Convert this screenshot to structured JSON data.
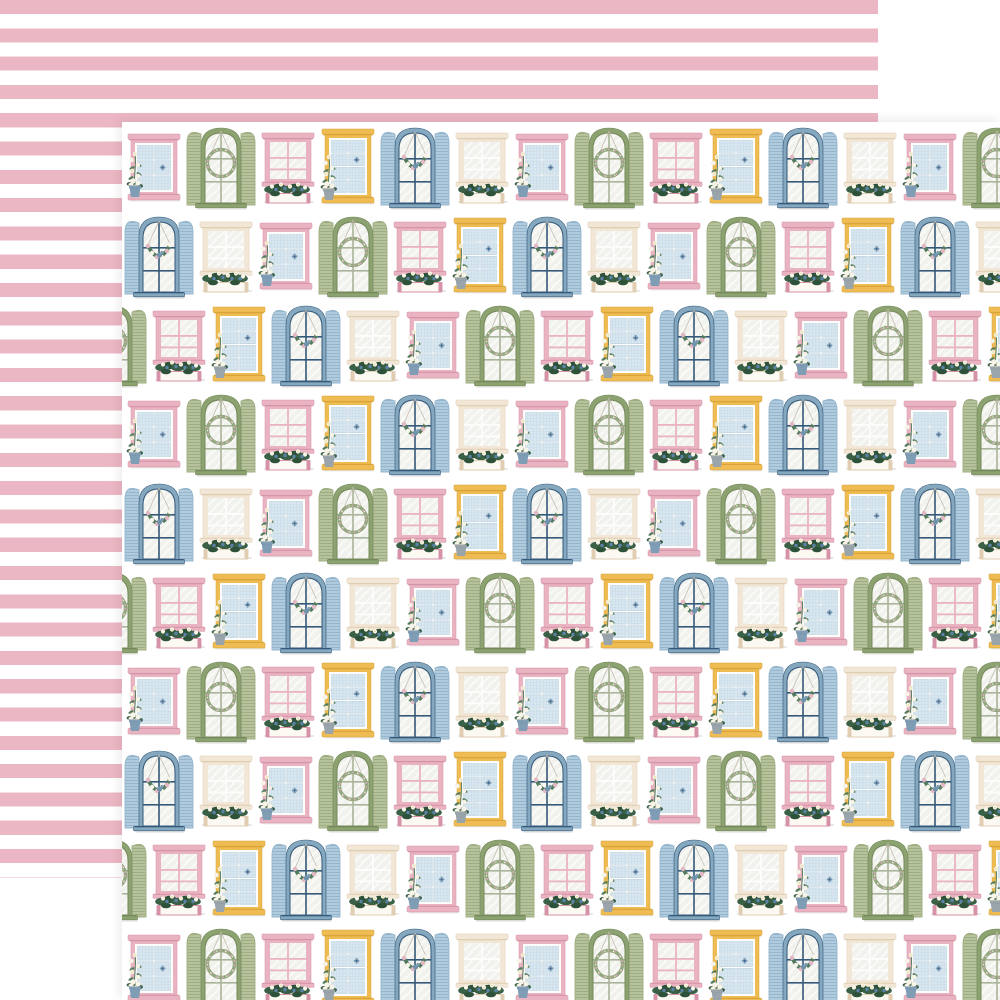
{
  "product": {
    "description": "Double-sided patterned scrapbook paper, front side with pastel cottage windows, reverse side with pink stripes",
    "front_motif": "cottage-windows-pattern",
    "back_motif": "pink-white-stripes"
  },
  "canvas": {
    "width": 1000,
    "height": 1000,
    "background": "#ffffff"
  },
  "back_sheet": {
    "x": 0,
    "y": 0,
    "size": 878,
    "stripe_color": "#ecb7c4",
    "gap_color": "#ffffff",
    "stripe_height": 14.15
  },
  "front_sheet": {
    "x": 122,
    "y": 122,
    "size": 878,
    "background": "#ffffff"
  },
  "palette": {
    "pane": "#d8e7f0",
    "pane_line": "#c6dae6",
    "pane_stroke": "#abc6d8",
    "glass": "#f1f2ee",
    "glass_streak": "#fbfbf8",
    "sash_white": "#fefdfb",
    "pink_frame": "#e9b3c1",
    "pink_dark": "#d693a8",
    "cream_frame": "#f2e7d6",
    "cream_dark": "#e0cdb2",
    "yellow_frame": "#eebc52",
    "yellow_dark": "#d8a338",
    "green_frame": "#8ca371",
    "green_dark": "#75885a",
    "green_shutter": "#b6c29c",
    "green_louver": "#9fae82",
    "green_muntin": "#a9b49a",
    "blue_frame": "#85a8bf",
    "blue_dark": "#34597a",
    "blue_shutter": "#b0cade",
    "blue_louver": "#95b6cc",
    "foliage": "#3a6146",
    "foliage_dark": "#2e5239",
    "foliage_light": "#527a5c",
    "stem": "#5d8266",
    "flower_white": "#f7f4ea",
    "flower_blue": "#5c82a8",
    "flower_pink": "#e3b7c6",
    "flower_center": "#e9cc6b",
    "wreath_green": "#93a87e",
    "wreath_pink": "#d8a8b8",
    "pot_blue": "#7f9db5",
    "pot_gray": "#9aa5ab",
    "string": "#c4bcae",
    "box_front": "#fcf9f2",
    "shadow": "rgba(110,105,100,0.16)"
  },
  "pattern": {
    "row_start_y": 3,
    "row_period": 89,
    "row_count": 10,
    "row_x_offsets": [
      2,
      0,
      27
    ],
    "row_type_starts": [
      0,
      4,
      2
    ],
    "sequence": [
      "pink_pot",
      "green_arch",
      "pink_box",
      "yellow_pot",
      "blue_arch",
      "cream_box"
    ]
  },
  "window_types": [
    {
      "id": "pink_pot",
      "kind": "pot",
      "frame": "pink_frame",
      "dark": "pink_dark",
      "rows": 3,
      "pot": "pot_blue",
      "w": 52,
      "h": 66,
      "dy": 9,
      "slot": 60
    },
    {
      "id": "green_arch",
      "kind": "arch",
      "frame": "green_frame",
      "dark": "green_dark",
      "shutter": "louvG",
      "shutter_stroke": "green_louver",
      "muntin": "green_muntin",
      "decor": "wreath",
      "w": 72,
      "h": 84,
      "dy": 0,
      "slot": 74
    },
    {
      "id": "pink_box",
      "kind": "box",
      "frame": "pink_frame",
      "dark": "pink_dark",
      "muntin": "pink_frame",
      "w": 52,
      "h": 70,
      "dy": 8,
      "slot": 60
    },
    {
      "id": "yellow_pot",
      "kind": "pot",
      "frame": "yellow_frame",
      "dark": "yellow_dark",
      "rows": 4,
      "pot": "pot_gray",
      "w": 52,
      "h": 74,
      "dy": 4,
      "slot": 60
    },
    {
      "id": "blue_arch",
      "kind": "arch",
      "frame": "blue_frame",
      "dark": "blue_dark",
      "shutter": "louvB",
      "shutter_stroke": "blue_louver",
      "muntin": "blue_dark",
      "decor": "swag",
      "w": 72,
      "h": 84,
      "dy": 0,
      "slot": 74
    },
    {
      "id": "cream_box",
      "kind": "box",
      "frame": "cream_frame",
      "dark": "cream_dark",
      "muntin": "sash_white",
      "w": 52,
      "h": 70,
      "dy": 8,
      "slot": 60
    }
  ]
}
